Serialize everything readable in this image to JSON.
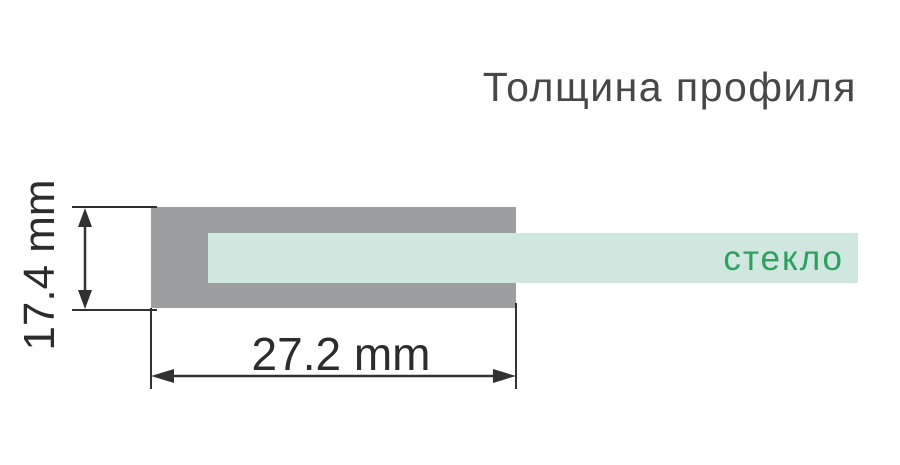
{
  "title": "Толщина профиля",
  "diagram": {
    "glass_label": "стекло",
    "dimensions": {
      "width": "27.2 mm",
      "height": "17.4 mm"
    },
    "colors": {
      "profile_gray": "#9d9e9f",
      "glass_mint": "#cfe7de",
      "glass_label_green": "#2f9f5f",
      "dimension_line": "#2f3133",
      "title_text": "#454749"
    }
  }
}
